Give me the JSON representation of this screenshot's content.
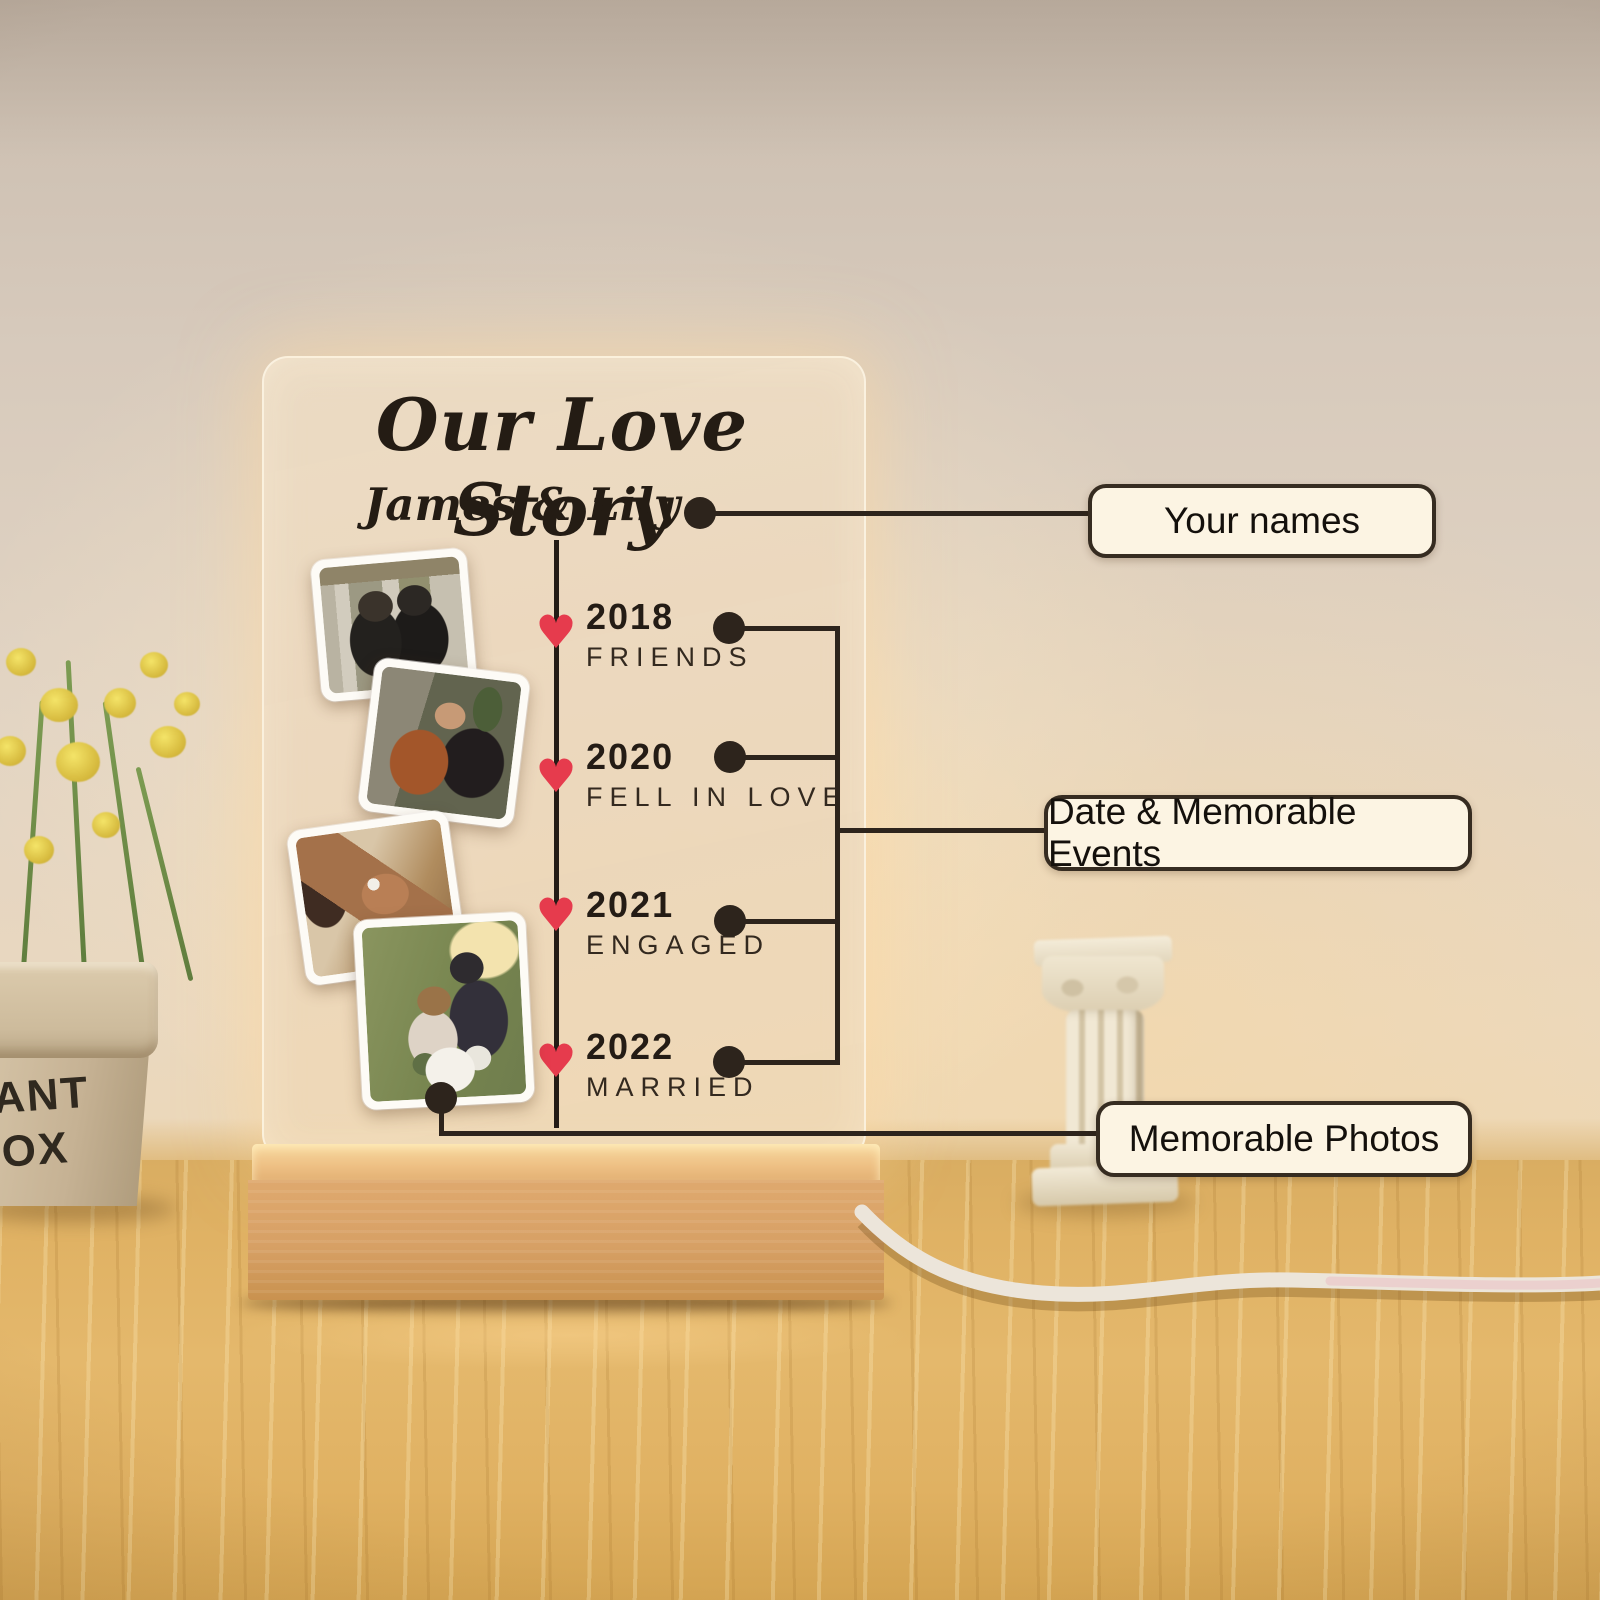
{
  "plaque": {
    "title": "Our Love Story",
    "names": "James & Lily",
    "timeline": [
      {
        "year": "2018",
        "label": "FRIENDS"
      },
      {
        "year": "2020",
        "label": "FELL IN LOVE"
      },
      {
        "year": "2021",
        "label": "ENGAGED"
      },
      {
        "year": "2022",
        "label": "MARRIED"
      }
    ],
    "photos": [
      {
        "name": "friends-photo"
      },
      {
        "name": "fell-in-love-photo"
      },
      {
        "name": "engagement-ring-photo"
      },
      {
        "name": "wedding-photo"
      }
    ]
  },
  "annotations": {
    "your_names": "Your names",
    "events": "Date & Memorable Events",
    "photos": "Memorable Photos"
  },
  "planter": {
    "line1": "LANT",
    "line2": "BOX"
  },
  "icons": {
    "heart": "♥"
  },
  "colors": {
    "heart_red": "#e63b4d",
    "timeline_ink": "#2d241c",
    "callout_bg": "#fcf4e3",
    "callout_border": "#362c21",
    "acrylic_tint": "#ebd7bc",
    "base_wood": "#d7a065",
    "desk_wood": "#e0b264",
    "wall": "#ddcfbf"
  }
}
